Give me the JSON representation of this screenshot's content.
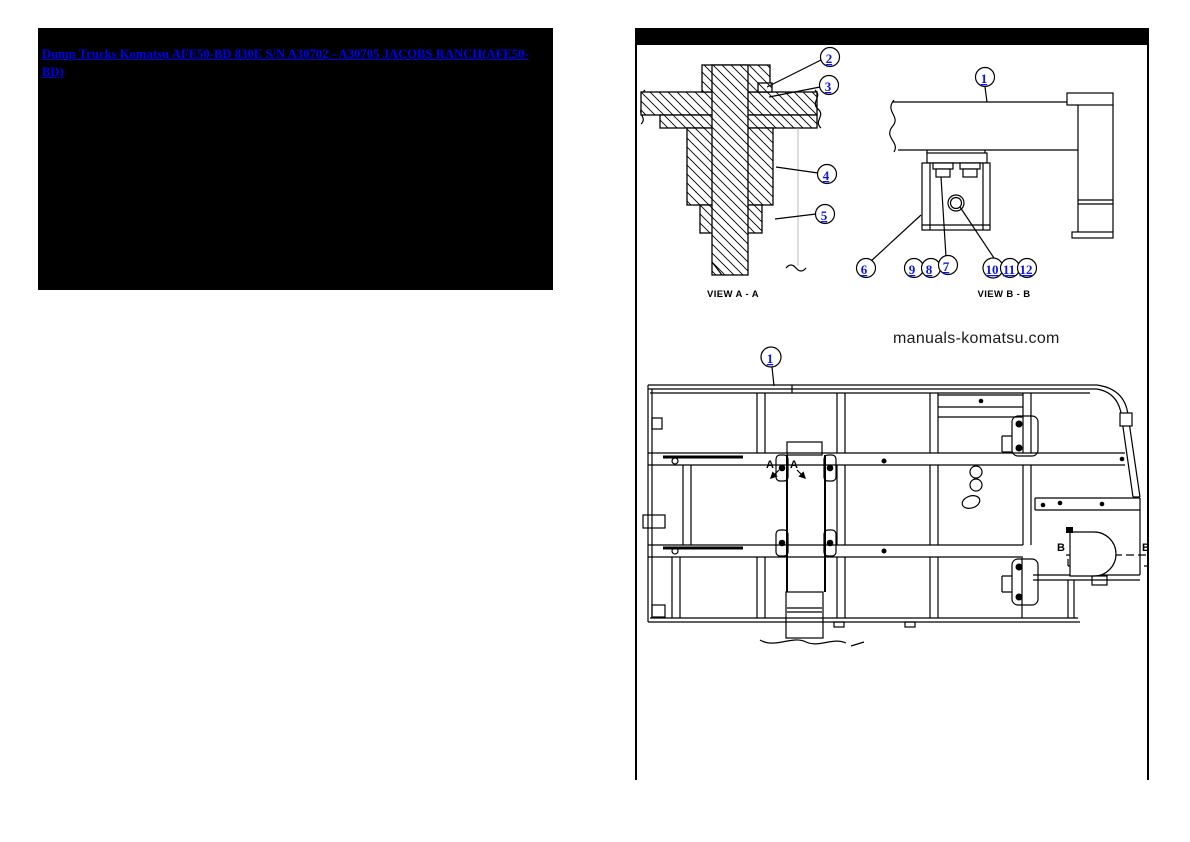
{
  "header": {
    "link_text": "Dump Trucks Komatsu AFE50-BD 830E S/N A30702 - A30705 JACOBS RANCH(AFE50-BD)"
  },
  "watermark": {
    "text": "manuals-komatsu.com"
  },
  "views": {
    "view_a": {
      "label": "VIEW A - A",
      "callouts": [
        "2",
        "3",
        "4",
        "5"
      ]
    },
    "view_b": {
      "label": "VIEW B - B",
      "callouts": [
        "1",
        "6",
        "9",
        "8",
        "7",
        "10",
        "11",
        "12"
      ]
    },
    "main": {
      "callouts": [
        "1"
      ],
      "marker_a": "A",
      "marker_b": "B"
    }
  },
  "colors": {
    "link_blue": "#0000ee",
    "callout_blue": "#0b14e6",
    "ink": "#000000",
    "header_bg": "#000000",
    "page_bg": "#ffffff"
  }
}
